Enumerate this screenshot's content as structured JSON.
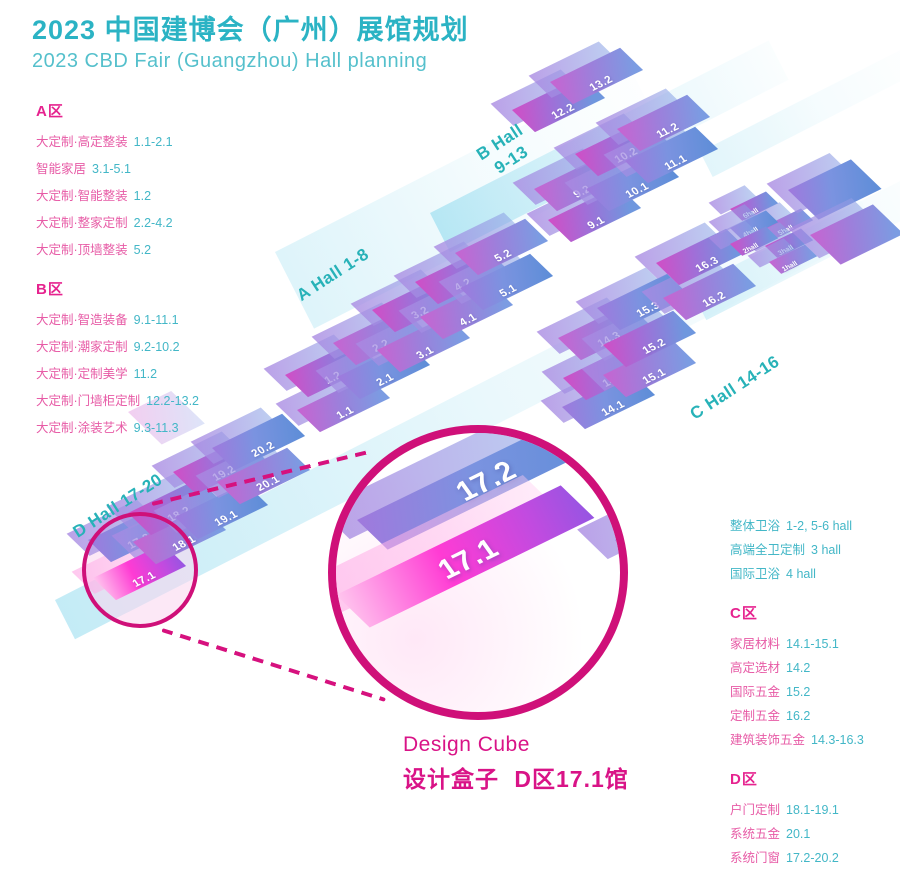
{
  "title": {
    "zh": "2023 中国建博会（广州）展馆规划",
    "en": "2023 CBD Fair (Guangzhou) Hall planning"
  },
  "colors": {
    "accent_magenta": "#cf1079",
    "teal": "#2bb3c4"
  },
  "legend_left": [
    {
      "header": "A区",
      "items": [
        {
          "name": "大定制·高定整装",
          "value": "1.1-2.1"
        },
        {
          "name": "智能家居",
          "value": "3.1-5.1"
        },
        {
          "name": "大定制·智能整装",
          "value": "1.2"
        },
        {
          "name": "大定制·整家定制",
          "value": "2.2-4.2"
        },
        {
          "name": "大定制·顶墙整装",
          "value": "5.2"
        }
      ]
    },
    {
      "header": "B区",
      "items": [
        {
          "name": "大定制·智造装备",
          "value": "9.1-11.1"
        },
        {
          "name": "大定制·潮家定制",
          "value": "9.2-10.2"
        },
        {
          "name": "大定制·定制美学",
          "value": "11.2"
        },
        {
          "name": "大定制·门墙柜定制",
          "value": "12.2-13.2"
        },
        {
          "name": "大定制·涂装艺术",
          "value": "9.3-11.3"
        }
      ]
    }
  ],
  "legend_right": {
    "hall_items": [
      {
        "name": "整体卫浴",
        "value": "1-2, 5-6 hall"
      },
      {
        "name": "高端全卫定制",
        "value": "3 hall"
      },
      {
        "name": "国际卫浴",
        "value": "4 hall"
      }
    ],
    "sections": [
      {
        "header": "C区",
        "items": [
          {
            "name": "家居材料",
            "value": "14.1-15.1"
          },
          {
            "name": "高定选材",
            "value": "14.2"
          },
          {
            "name": "国际五金",
            "value": "15.2"
          },
          {
            "name": "定制五金",
            "value": "16.2"
          },
          {
            "name": "建筑装饰五金",
            "value": "14.3-16.3"
          }
        ]
      },
      {
        "header": "D区",
        "items": [
          {
            "name": "户门定制",
            "value": "18.1-19.1"
          },
          {
            "name": "系统五金",
            "value": "20.1"
          },
          {
            "name": "系统门窗",
            "value": "17.2-20.2"
          }
        ]
      }
    ]
  },
  "map": {
    "hall_labels": {
      "a": "A Hall 1-8",
      "b1": "B Hall",
      "b2": "9-13",
      "c": "C Hall 14-16",
      "d": "D Hall 17-20"
    },
    "tiles": [
      {
        "label": "1.1",
        "x": 297,
        "y": 410,
        "v": 1
      },
      {
        "label": "1.2",
        "x": 285,
        "y": 375,
        "v": 2
      },
      {
        "label": "2.1",
        "x": 337,
        "y": 377,
        "v": 3
      },
      {
        "label": "2.2",
        "x": 333,
        "y": 343,
        "v": 1
      },
      {
        "label": "3.1",
        "x": 377,
        "y": 350,
        "v": 1
      },
      {
        "label": "3.2",
        "x": 372,
        "y": 310,
        "v": 2
      },
      {
        "label": "4.1",
        "x": 420,
        "y": 317,
        "v": 1
      },
      {
        "label": "4.2",
        "x": 415,
        "y": 282,
        "v": 2
      },
      {
        "label": "5.1",
        "x": 460,
        "y": 288,
        "v": 3
      },
      {
        "label": "5.2",
        "x": 455,
        "y": 253,
        "v": 1
      },
      {
        "label": "9.1",
        "x": 548,
        "y": 220,
        "v": 2
      },
      {
        "label": "9.2",
        "x": 534,
        "y": 189,
        "v": 1
      },
      {
        "label": "10.1",
        "x": 586,
        "y": 189,
        "v": 3
      },
      {
        "label": "10.2",
        "x": 575,
        "y": 154,
        "v": 2
      },
      {
        "label": "11.1",
        "x": 625,
        "y": 161,
        "v": 3
      },
      {
        "label": "11.2",
        "x": 617,
        "y": 129,
        "v": 1
      },
      {
        "label": "12.2",
        "x": 512,
        "y": 110,
        "v": 2
      },
      {
        "label": "13.2",
        "x": 550,
        "y": 82,
        "v": 1
      },
      {
        "label": "14.1",
        "x": 562,
        "y": 407,
        "v": 3
      },
      {
        "label": "14.2",
        "x": 563,
        "y": 378,
        "v": 2
      },
      {
        "label": "14.3",
        "x": 558,
        "y": 338,
        "v": 1
      },
      {
        "label": "15.1",
        "x": 603,
        "y": 375,
        "v": 1
      },
      {
        "label": "15.2",
        "x": 603,
        "y": 345,
        "v": 2
      },
      {
        "label": "15.3",
        "x": 597,
        "y": 308,
        "v": 3
      },
      {
        "label": "16.2",
        "x": 663,
        "y": 298,
        "v": 1
      },
      {
        "label": "16.3",
        "x": 656,
        "y": 263,
        "v": 2
      },
      {
        "label": "17.1",
        "x": 93,
        "y": 578,
        "v": 9
      },
      {
        "label": "17.2",
        "x": 88,
        "y": 540,
        "v": 3
      },
      {
        "label": "18.1",
        "x": 133,
        "y": 542,
        "v": 1
      },
      {
        "label": "18.2",
        "x": 128,
        "y": 513,
        "v": 2
      },
      {
        "label": "19.1",
        "x": 175,
        "y": 517,
        "v": 3
      },
      {
        "label": "19.2",
        "x": 173,
        "y": 472,
        "v": 2
      },
      {
        "label": "20.1",
        "x": 217,
        "y": 482,
        "v": 1
      },
      {
        "label": "20.2",
        "x": 212,
        "y": 448,
        "v": 3
      },
      {
        "label": "6hall",
        "x": 730,
        "y": 209,
        "v": 2,
        "mini": true
      },
      {
        "label": "5hall",
        "x": 765,
        "y": 226,
        "v": 1,
        "mini": true
      },
      {
        "label": "4hall",
        "x": 730,
        "y": 228,
        "v": 3,
        "mini": true
      },
      {
        "label": "3hall",
        "x": 765,
        "y": 246,
        "v": 2,
        "mini": true
      },
      {
        "label": "2hall",
        "x": 730,
        "y": 244,
        "v": 2,
        "mini": true
      },
      {
        "label": "1hall",
        "x": 769,
        "y": 262,
        "v": 1,
        "mini": true
      },
      {
        "x": 788,
        "y": 190,
        "v": 3,
        "w": 70,
        "h": 40
      },
      {
        "x": 810,
        "y": 235,
        "v": 1,
        "w": 70,
        "h": 40
      }
    ]
  },
  "callout": {
    "tiles": [
      {
        "label": "17.2",
        "x": 21,
        "y": 87,
        "v": 3,
        "w": 250,
        "h": 40,
        "big": true
      },
      {
        "label": "17.1",
        "x": 0,
        "y": 162,
        "v": 9,
        "w": 250,
        "h": 44,
        "big": true
      },
      {
        "x": 279,
        "y": 107,
        "v": 3,
        "w": 120,
        "h": 40,
        "big": true
      }
    ],
    "caption1": "Design Cube",
    "caption2": "设计盒子 D区17.1馆"
  }
}
